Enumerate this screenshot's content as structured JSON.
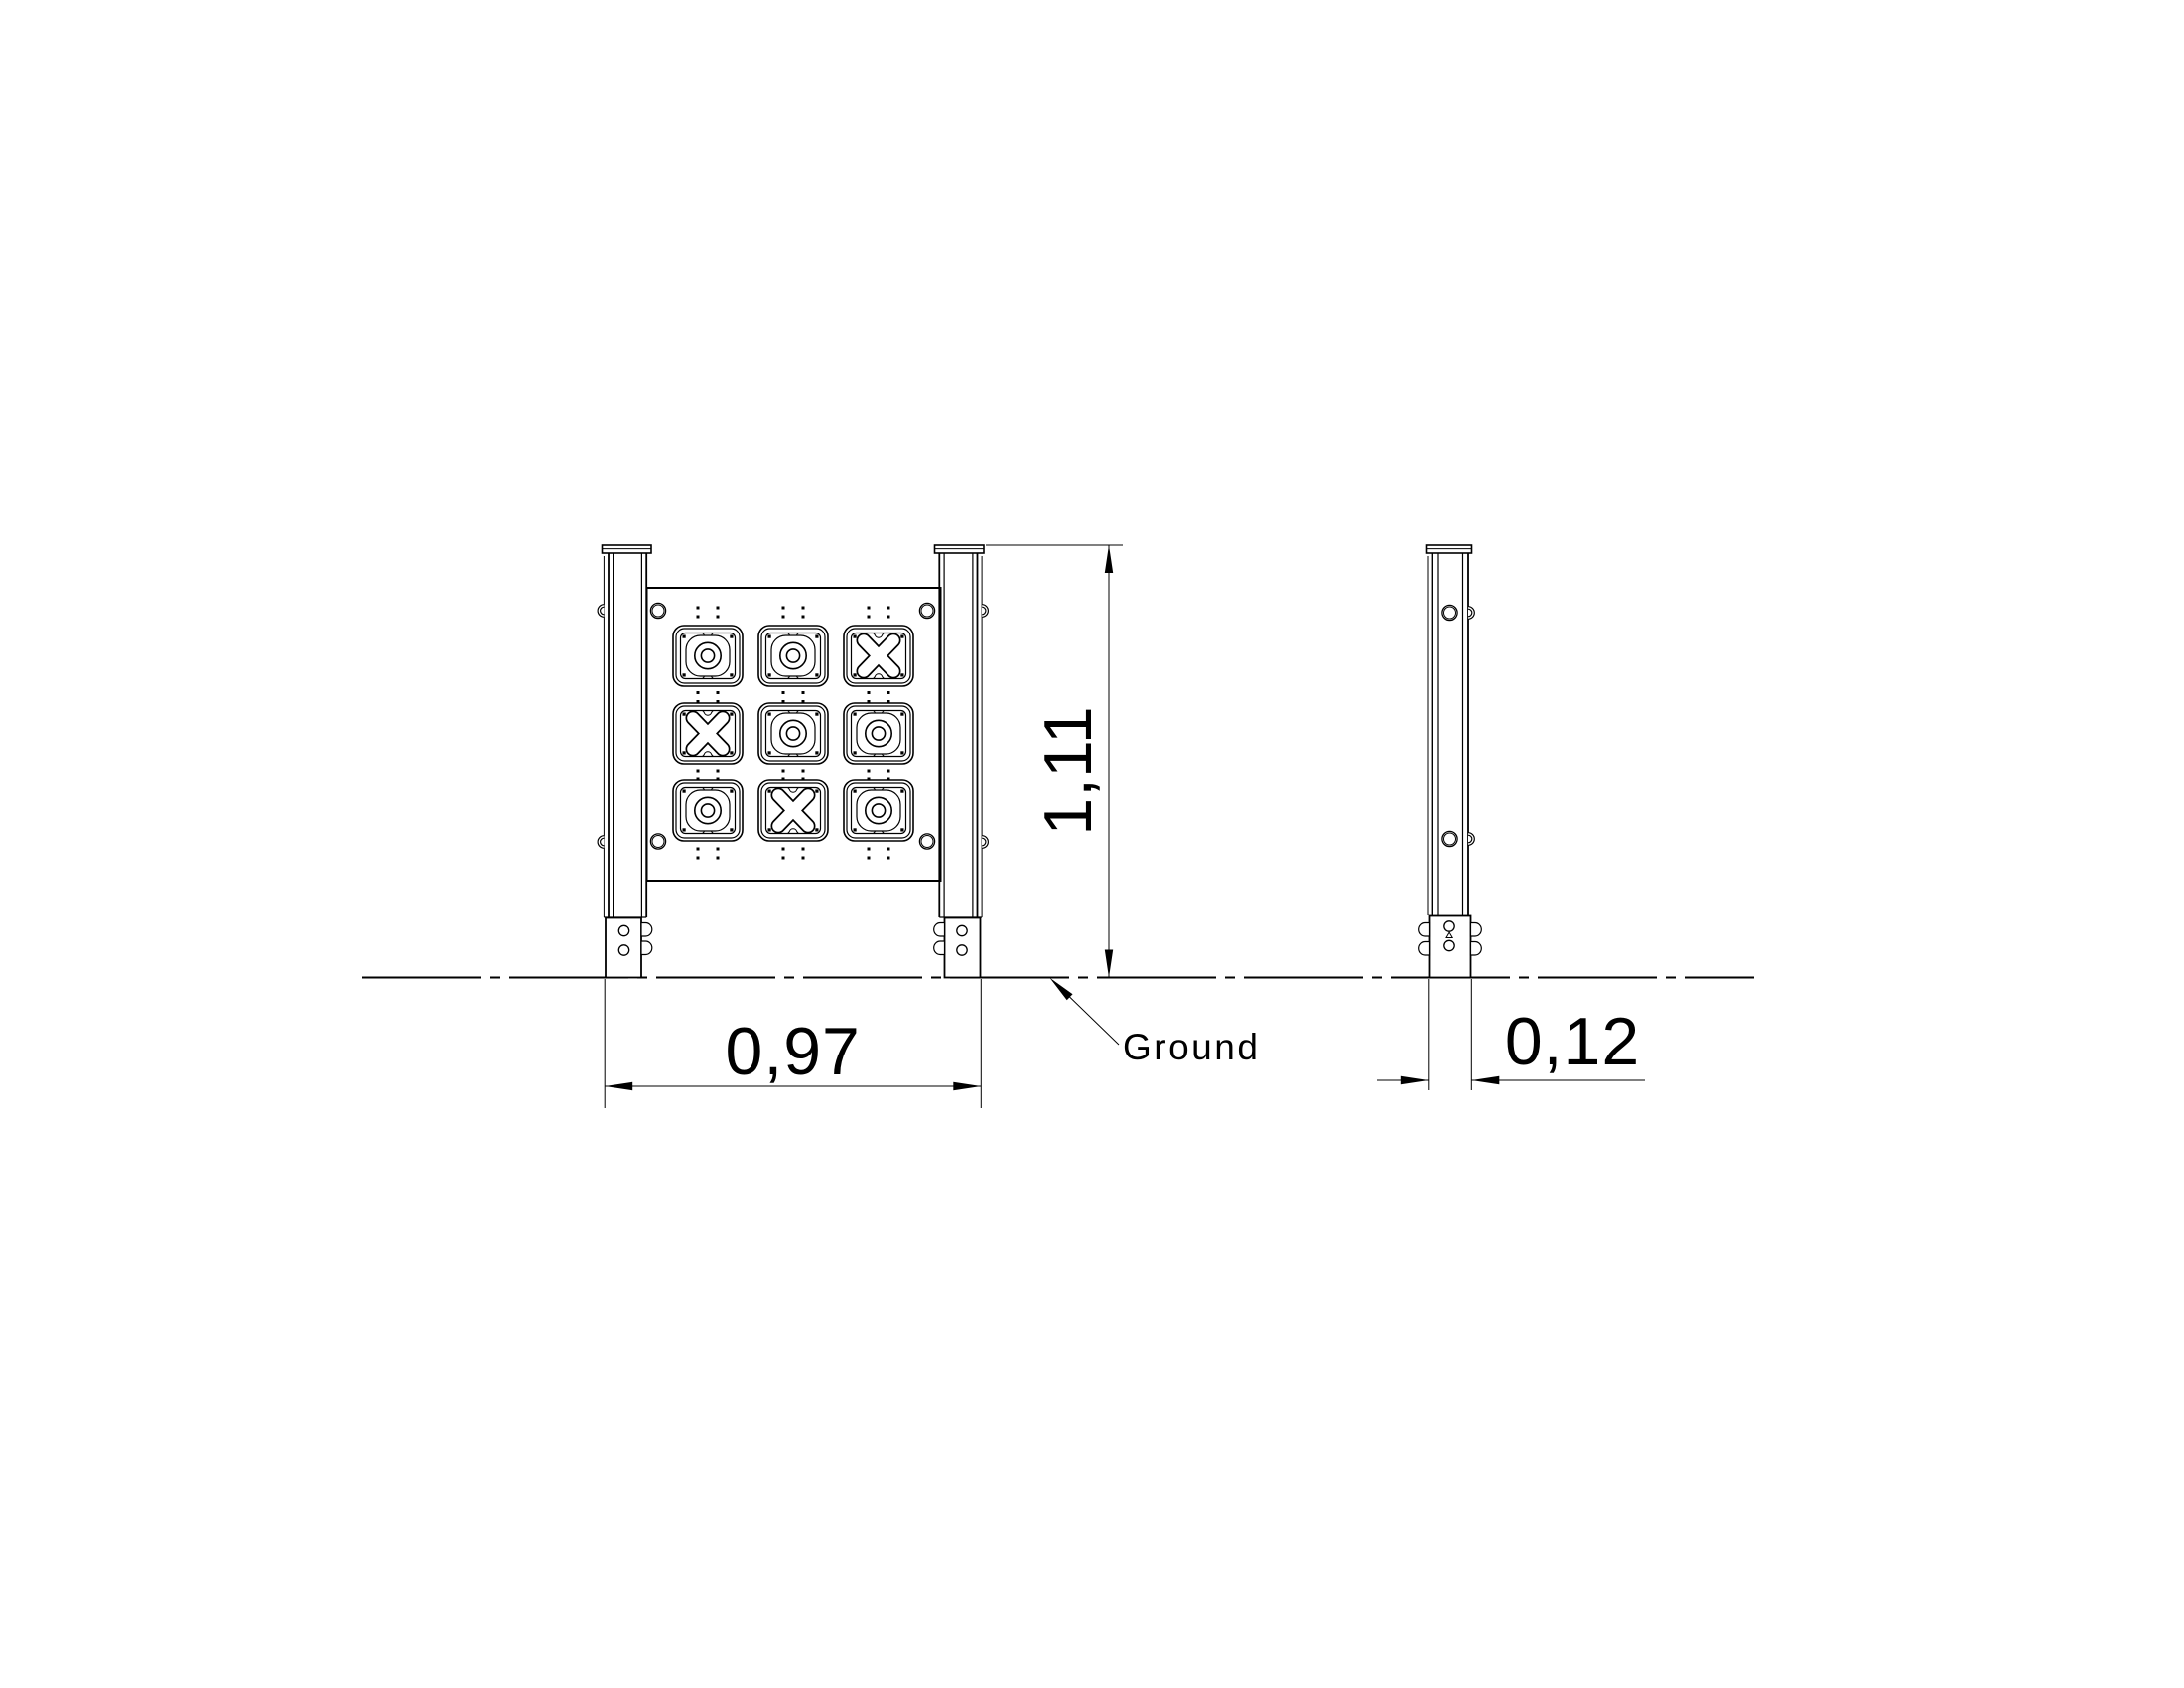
{
  "page": {
    "background_color": "#ffffff",
    "line_color": "#000000"
  },
  "dimensions": {
    "width": {
      "value": "0,97"
    },
    "height": {
      "value": "1,11"
    },
    "depth": {
      "value": "0,12"
    }
  },
  "annotations": {
    "ground_label": "Ground"
  },
  "game_panel": {
    "grid_rows": 3,
    "grid_cols": 3,
    "grid": [
      [
        "O",
        "O",
        "X"
      ],
      [
        "X",
        "O",
        "O"
      ],
      [
        "O",
        "X",
        "O"
      ]
    ]
  }
}
